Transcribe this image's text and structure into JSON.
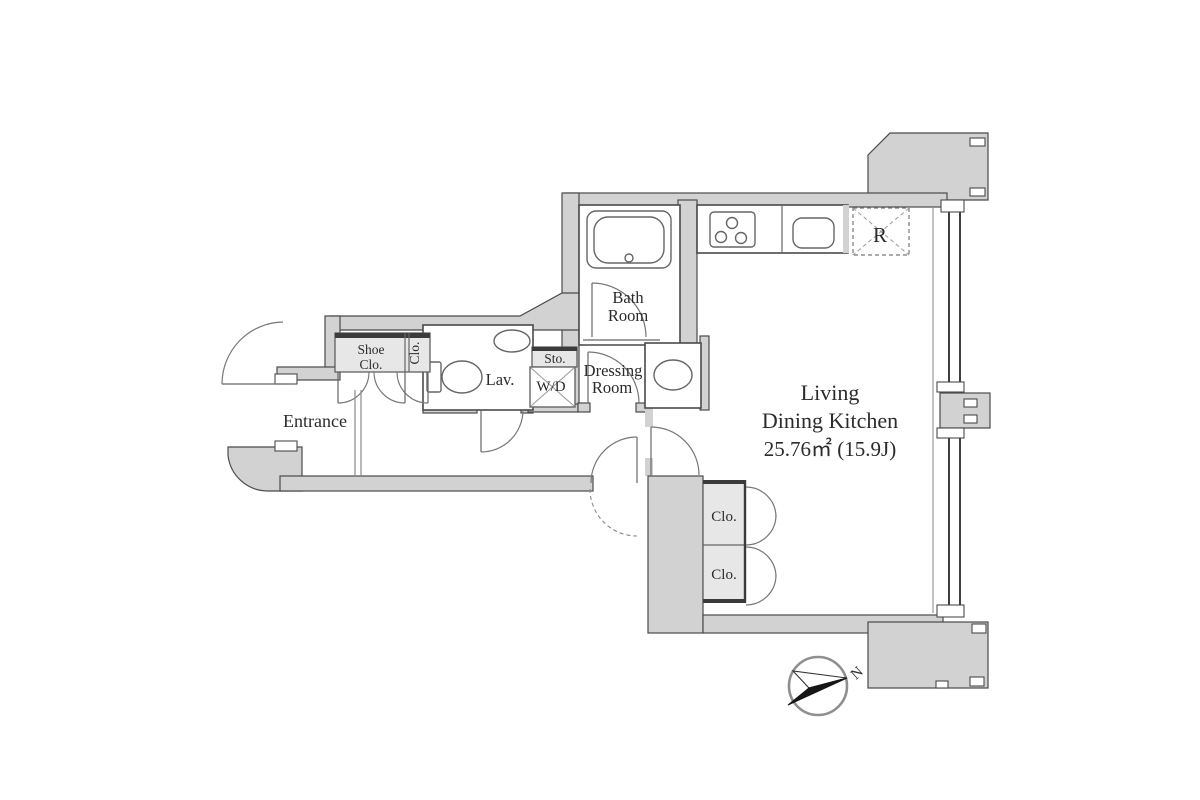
{
  "plan": {
    "type": "apartment-floor-plan",
    "colors": {
      "wall_fill": "#d2d2d2",
      "wall_stroke": "#4a4a4a",
      "cabinet_fill": "#e7e7e7",
      "dark_edge": "#3b3b3b",
      "text": "#2b2b2b",
      "background": "#ffffff"
    },
    "rooms": {
      "entrance": {
        "label": "Entrance"
      },
      "shoe_closet": {
        "line1": "Shoe",
        "line2": "Clo."
      },
      "hall_closet": {
        "label": "Clo."
      },
      "lavatory": {
        "label": "Lav."
      },
      "storage": {
        "label": "Sto."
      },
      "washer_dryer": {
        "label": "W/D"
      },
      "dressing_room": {
        "line1": "Dressing",
        "line2": "Room"
      },
      "bath_room": {
        "line1": "Bath",
        "line2": "Room"
      },
      "ldk": {
        "line1": "Living",
        "line2": "Dining Kitchen",
        "area": "25.76㎡ (15.9J)"
      },
      "closet_upper": {
        "label": "Clo."
      },
      "closet_lower": {
        "label": "Clo."
      },
      "refrigerator": {
        "label": "R"
      }
    },
    "compass": {
      "label": "N"
    }
  }
}
